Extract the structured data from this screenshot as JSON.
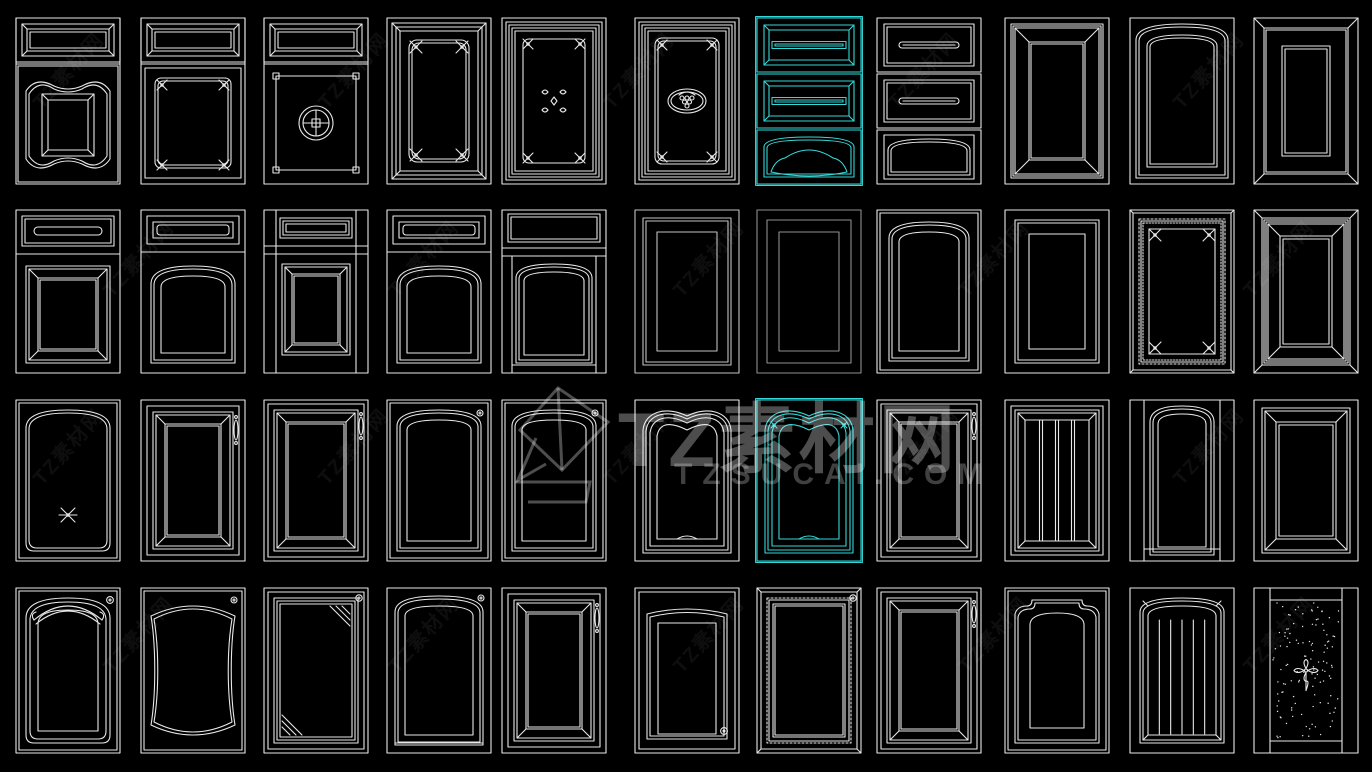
{
  "canvas": {
    "width": 1372,
    "height": 772,
    "background": "#000000"
  },
  "palette": {
    "line": "#e8e8e8",
    "mid": "#c2c2c2",
    "dim": "#8f8f8f",
    "accent": "#35d8d8",
    "watermark": "rgba(255,255,255,0.30)"
  },
  "watermark": {
    "title": "TZ素材网",
    "domain": "TZSUCAI.COM",
    "tile_text": "TZ素材网"
  },
  "grid": {
    "col_x": [
      14,
      139,
      262,
      385,
      500,
      633,
      755,
      875,
      1003,
      1128,
      1252
    ],
    "cell_w": 108,
    "rows": [
      {
        "y": 16,
        "h": 170
      },
      {
        "y": 208,
        "h": 167
      },
      {
        "y": 398,
        "h": 165
      },
      {
        "y": 586,
        "h": 169
      }
    ]
  },
  "items": [
    {
      "r": 0,
      "c": 0,
      "t": "combo_scallop"
    },
    {
      "r": 0,
      "c": 1,
      "t": "combo_corner_cross"
    },
    {
      "r": 0,
      "c": 2,
      "t": "combo_coin"
    },
    {
      "r": 0,
      "c": 3,
      "t": "panel_corner_cross"
    },
    {
      "r": 0,
      "c": 4,
      "t": "panel_stars"
    },
    {
      "r": 0,
      "c": 5,
      "t": "panel_grapes"
    },
    {
      "r": 0,
      "c": 6,
      "t": "drawer_stack_bevel",
      "sel": true
    },
    {
      "r": 0,
      "c": 7,
      "t": "drawer_stack_slab"
    },
    {
      "r": 0,
      "c": 8,
      "t": "panel_plain"
    },
    {
      "r": 0,
      "c": 9,
      "t": "panel_arch_simple"
    },
    {
      "r": 0,
      "c": 10,
      "t": "panel_bevel_wide"
    },
    {
      "r": 1,
      "c": 0,
      "t": "dd_rect"
    },
    {
      "r": 1,
      "c": 1,
      "t": "dd_arch"
    },
    {
      "r": 1,
      "c": 2,
      "t": "dd_rect_stile"
    },
    {
      "r": 1,
      "c": 3,
      "t": "dd_arch"
    },
    {
      "r": 1,
      "c": 4,
      "t": "dd_arch_stile"
    },
    {
      "r": 1,
      "c": 5,
      "t": "framed_rect",
      "tone": "mid"
    },
    {
      "r": 1,
      "c": 6,
      "t": "framed_rect_thin",
      "tone": "dim"
    },
    {
      "r": 1,
      "c": 7,
      "t": "arch_full"
    },
    {
      "r": 1,
      "c": 8,
      "t": "framed_rect2"
    },
    {
      "r": 1,
      "c": 9,
      "t": "beaded_ornate"
    },
    {
      "r": 1,
      "c": 10,
      "t": "bevel_multi"
    },
    {
      "r": 2,
      "c": 0,
      "t": "arch_x"
    },
    {
      "r": 2,
      "c": 1,
      "t": "rect_handle_frame"
    },
    {
      "r": 2,
      "c": 2,
      "t": "rect_handle"
    },
    {
      "r": 2,
      "c": 3,
      "t": "arch_knob"
    },
    {
      "r": 2,
      "c": 4,
      "t": "arch_knob"
    },
    {
      "r": 2,
      "c": 5,
      "t": "cathedral"
    },
    {
      "r": 2,
      "c": 6,
      "t": "cathedral",
      "sel": true
    },
    {
      "r": 2,
      "c": 7,
      "t": "rect_handle"
    },
    {
      "r": 2,
      "c": 8,
      "t": "slats"
    },
    {
      "r": 2,
      "c": 9,
      "t": "arch_stiles"
    },
    {
      "r": 2,
      "c": 10,
      "t": "panel_bevel"
    },
    {
      "r": 3,
      "c": 0,
      "t": "crest_arch"
    },
    {
      "r": 3,
      "c": 1,
      "t": "serpentine_knob"
    },
    {
      "r": 3,
      "c": 2,
      "t": "glass_corner_knob"
    },
    {
      "r": 3,
      "c": 3,
      "t": "arch_knob2"
    },
    {
      "r": 3,
      "c": 4,
      "t": "rect_handle_frame"
    },
    {
      "r": 3,
      "c": 5,
      "t": "soft_arch_knob"
    },
    {
      "r": 3,
      "c": 6,
      "t": "beaded_knob"
    },
    {
      "r": 3,
      "c": 7,
      "t": "rect_handle"
    },
    {
      "r": 3,
      "c": 8,
      "t": "ogee_shoulder"
    },
    {
      "r": 3,
      "c": 9,
      "t": "arch_beadboard"
    },
    {
      "r": 3,
      "c": 10,
      "t": "stipple_glass"
    }
  ]
}
